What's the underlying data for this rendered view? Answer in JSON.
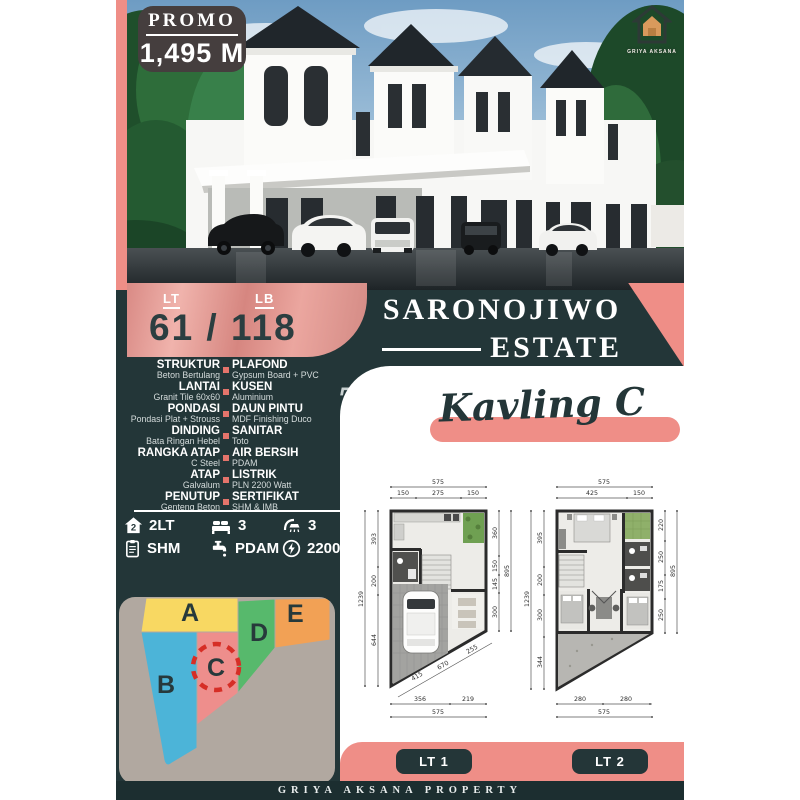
{
  "promo": {
    "label": "PROMO",
    "price": "1,495 M"
  },
  "logo_text": "GRIYA AKSANA",
  "land": {
    "lt_label": "LT",
    "lb_label": "LB",
    "value": "61 / 118"
  },
  "estate": {
    "name_line1": "SARONOJIWO",
    "name_line2": "ESTATE"
  },
  "kavling_title": "Kavling C",
  "watermark": "T",
  "specs": [
    {
      "left_label": "STRUKTUR",
      "left_value": "Beton Bertulang",
      "right_label": "PLAFOND",
      "right_value": "Gypsum Board + PVC"
    },
    {
      "left_label": "LANTAI",
      "left_value": "Granit Tile 60x60",
      "right_label": "KUSEN",
      "right_value": "Aluminium"
    },
    {
      "left_label": "PONDASI",
      "left_value": "Pondasi Plat + Strouss",
      "right_label": "DAUN PINTU",
      "right_value": "MDF Finishing Duco"
    },
    {
      "left_label": "DINDING",
      "left_value": "Bata Ringan Hebel",
      "right_label": "SANITAR",
      "right_value": "Toto"
    },
    {
      "left_label": "RANGKA ATAP",
      "left_value": "C Steel",
      "right_label": "AIR BERSIH",
      "right_value": "PDAM"
    },
    {
      "left_label": "ATAP",
      "left_value": "Galvalum",
      "right_label": "LISTRIK",
      "right_value": "PLN 2200 Watt"
    },
    {
      "left_label": "PENUTUP",
      "left_value": "Genteng Beton",
      "right_label": "SERTIFIKAT",
      "right_value": "SHM & IMB"
    }
  ],
  "features": {
    "row1": [
      {
        "icon": "house-2-floors",
        "label": "2LT"
      },
      {
        "icon": "bed",
        "label": "3"
      },
      {
        "icon": "shower",
        "label": "3"
      }
    ],
    "row2": [
      {
        "icon": "certificate",
        "label": "SHM"
      },
      {
        "icon": "water-tap",
        "label": "PDAM"
      },
      {
        "icon": "electric-power",
        "label": "2200 VA"
      }
    ]
  },
  "siteplan": {
    "blocks": [
      {
        "id": "A",
        "color": "#f8d862"
      },
      {
        "id": "B",
        "color": "#4cb4d8"
      },
      {
        "id": "C",
        "color": "#ee8e8c"
      },
      {
        "id": "D",
        "color": "#57b96c"
      },
      {
        "id": "E",
        "color": "#f2a155"
      }
    ],
    "highlighted_block": "C"
  },
  "floorplans": {
    "lt1": {
      "label": "LT 1",
      "dim_total_top": "575",
      "dims_top": [
        "150",
        "275",
        "150"
      ],
      "dims_left": [
        "393",
        "200",
        "644"
      ],
      "dim_total_left": "1239",
      "dims_right": [
        "360",
        "150",
        "145",
        "300"
      ],
      "dim_total_right": "895",
      "dims_bottom": [
        "356",
        "219"
      ],
      "dim_total_bottom": "575",
      "dims_diagonal": [
        "415",
        "670",
        "255"
      ]
    },
    "lt2": {
      "label": "LT 2",
      "dim_total_top": "575",
      "dims_top": [
        "425",
        "150"
      ],
      "dims_left": [
        "395",
        "200",
        "300",
        "344"
      ],
      "dim_total_left": "1239",
      "dims_right": [
        "220",
        "250",
        "175",
        "250"
      ],
      "dim_total_right": "895",
      "dims_bottom": [
        "280",
        "280"
      ],
      "dim_total_bottom": "575"
    }
  },
  "footer_text": "GRIYA AKSANA PROPERTY",
  "colors": {
    "background_dark": "#233638",
    "salmon": "#ef8e87",
    "panel_white": "#ffffff",
    "siteplan_bg": "#b1a8a0",
    "promo_badge": "#453e3e",
    "highlight_red": "#d62e26"
  }
}
